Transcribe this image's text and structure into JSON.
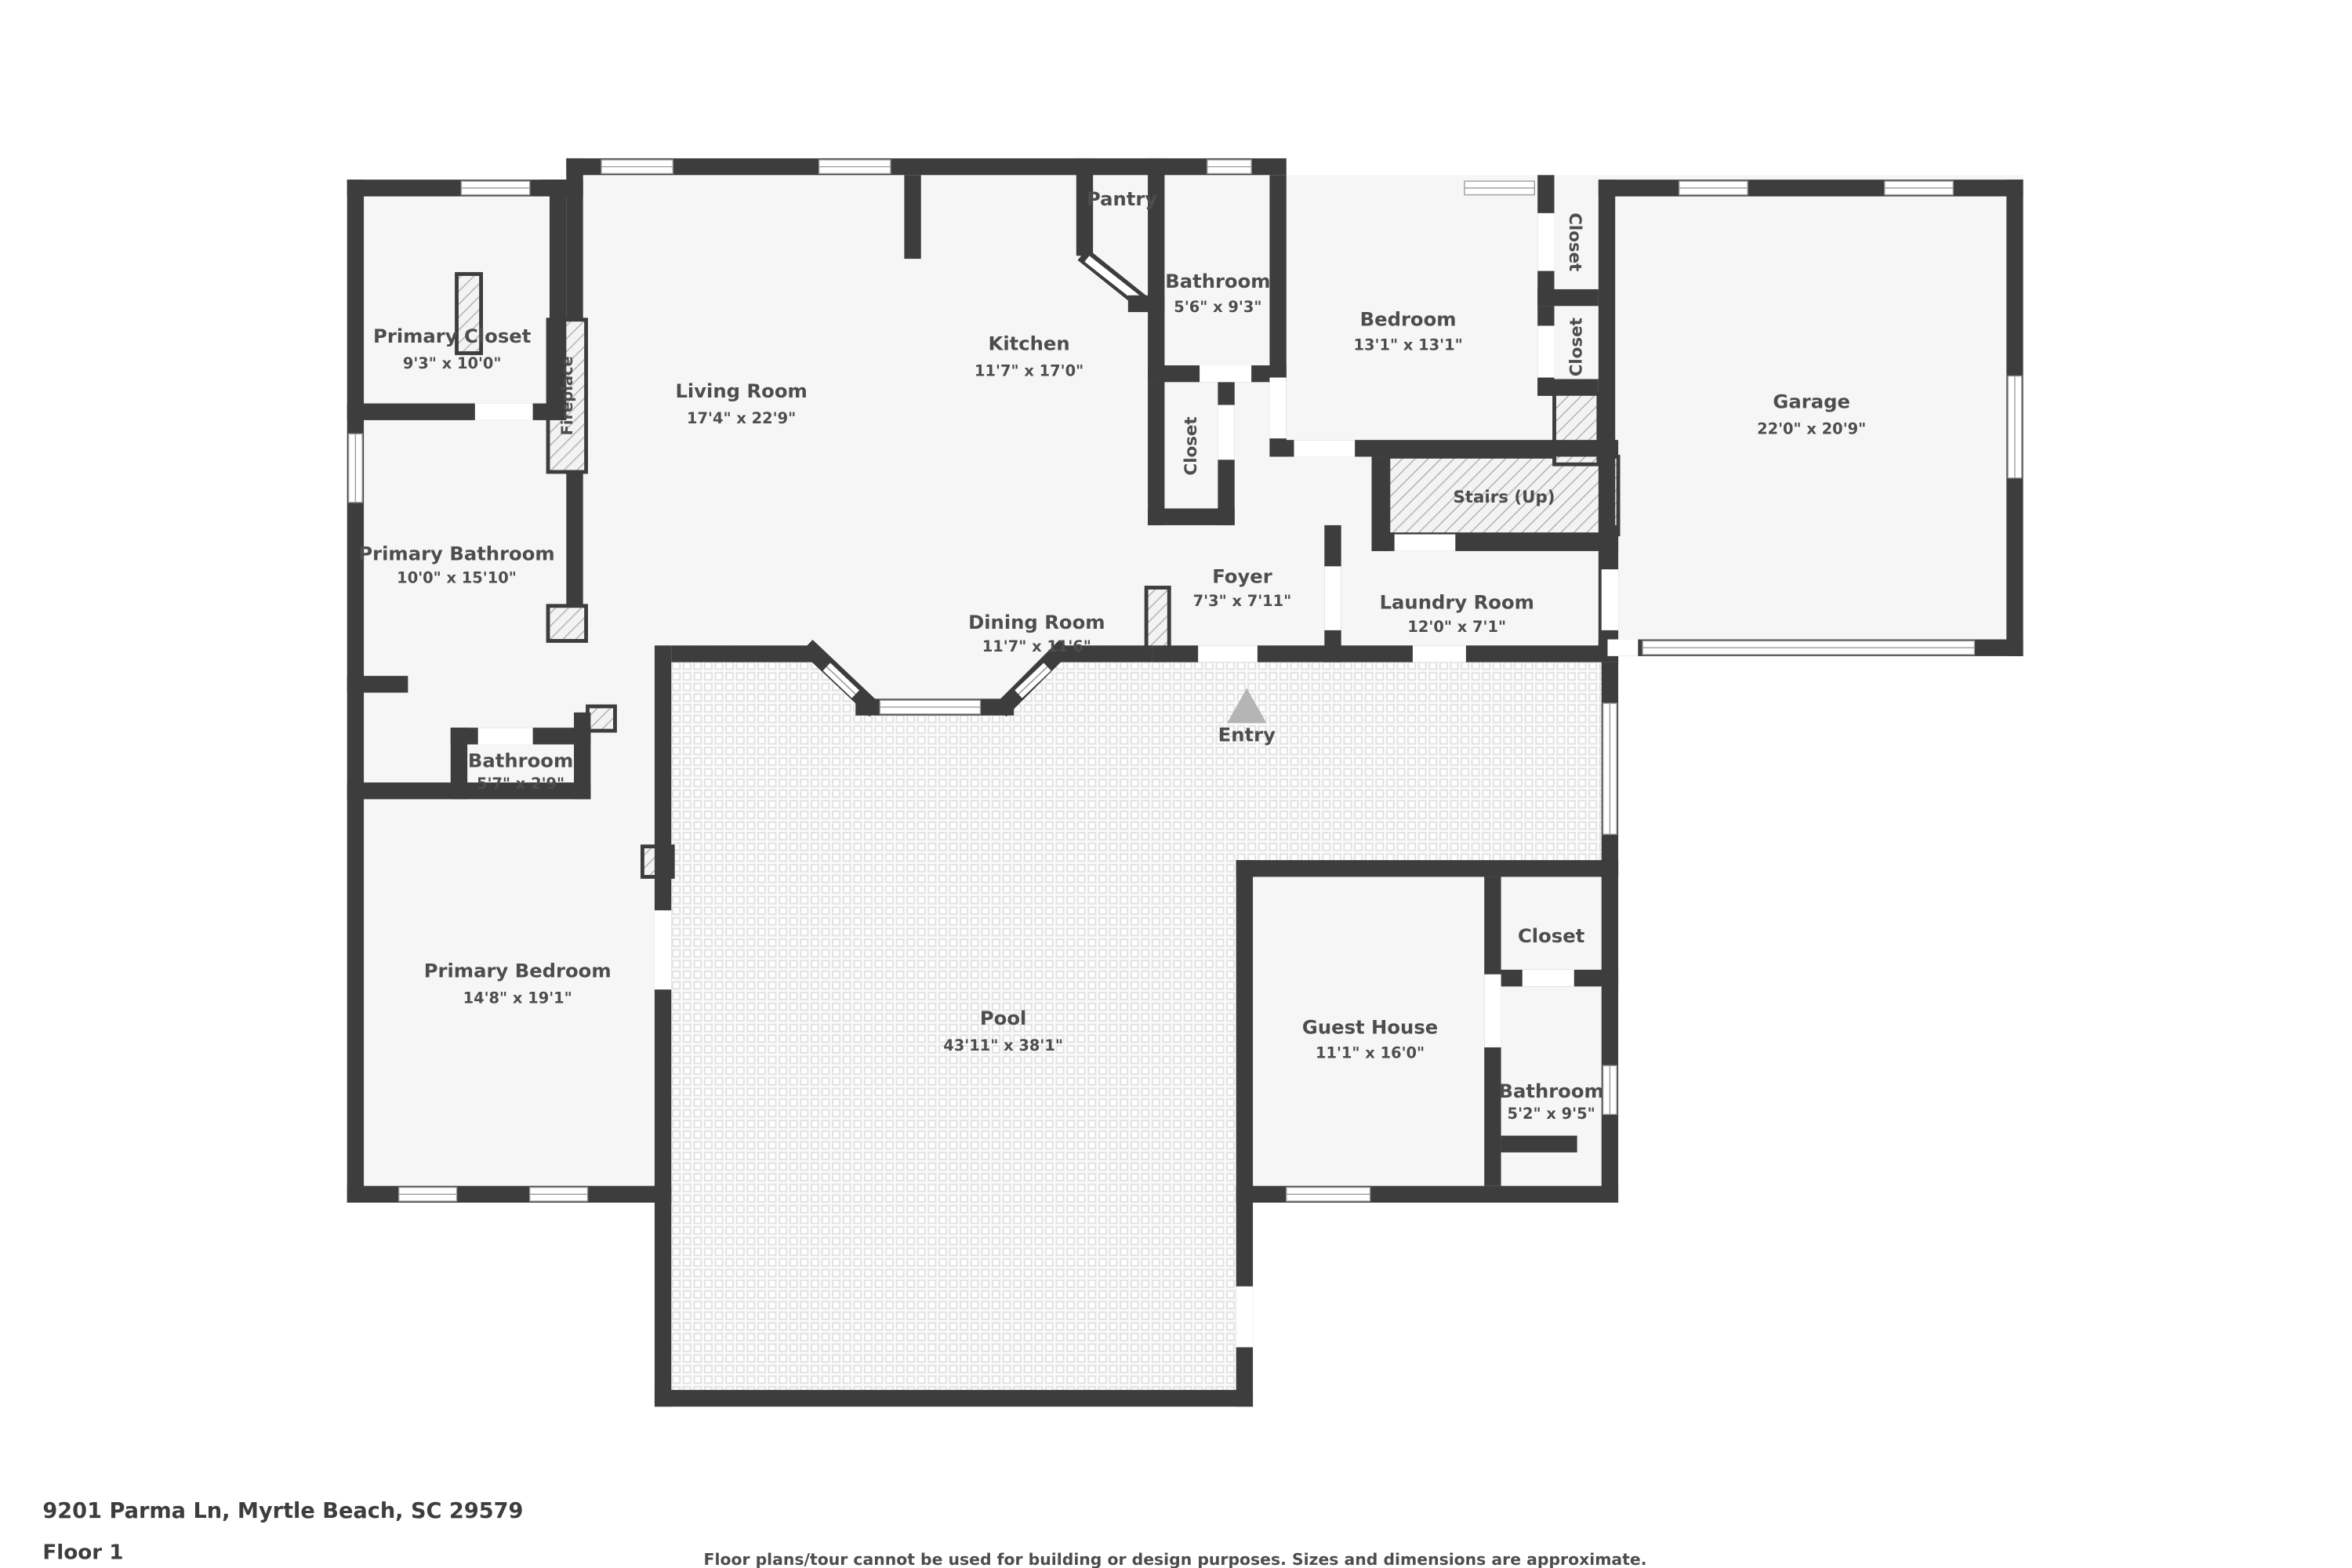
{
  "palette": {
    "wall": "#3d3d3d",
    "room_fill": "#f6f6f6",
    "tile_line": "#e3e3e3",
    "hatch_line": "#b5b5b5",
    "text": "#4d4d4d",
    "entry_arrow": "#b5b5b5"
  },
  "rooms": {
    "primary_closet": {
      "name": "Primary Closet",
      "dims": "9'3\" x 10'0\""
    },
    "fireplace": {
      "name": "Fireplace"
    },
    "living_room": {
      "name": "Living Room",
      "dims": "17'4\" x 22'9\""
    },
    "kitchen": {
      "name": "Kitchen",
      "dims": "11'7\" x 17'0\""
    },
    "pantry": {
      "name": "Pantry"
    },
    "bathroom_main": {
      "name": "Bathroom",
      "dims": "5'6\" x 9'3\""
    },
    "closet_kitchen": {
      "name": "Closet"
    },
    "bedroom": {
      "name": "Bedroom",
      "dims": "13'1\" x 13'1\""
    },
    "closet_bedroom_1": {
      "name": "Closet"
    },
    "closet_bedroom_2": {
      "name": "Closet"
    },
    "garage": {
      "name": "Garage",
      "dims": "22'0\" x 20'9\""
    },
    "stairs": {
      "name": "Stairs (Up)"
    },
    "foyer": {
      "name": "Foyer",
      "dims": "7'3\" x 7'11\""
    },
    "laundry": {
      "name": "Laundry Room",
      "dims": "12'0\" x 7'1\""
    },
    "primary_bathroom": {
      "name": "Primary Bathroom",
      "dims": "10'0\" x 15'10\""
    },
    "bathroom_hall": {
      "name": "Bathroom",
      "dims": "5'7\" x 2'9\""
    },
    "dining": {
      "name": "Dining Room",
      "dims": "11'7\" x 11'6\""
    },
    "entry": {
      "name": "Entry"
    },
    "primary_bedroom": {
      "name": "Primary Bedroom",
      "dims": "14'8\" x 19'1\""
    },
    "pool": {
      "name": "Pool",
      "dims": "43'11\" x 38'1\""
    },
    "guest_house": {
      "name": "Guest House",
      "dims": "11'1\" x 16'0\""
    },
    "closet_guest": {
      "name": "Closet"
    },
    "bathroom_guest": {
      "name": "Bathroom",
      "dims": "5'2\" x 9'5\""
    }
  },
  "footer": {
    "address": "9201 Parma Ln, Myrtle Beach, SC 29579",
    "floor_label": "Floor 1",
    "disclaimer": "Floor plans/tour cannot be used for building or design purposes. Sizes and dimensions are approximate."
  }
}
